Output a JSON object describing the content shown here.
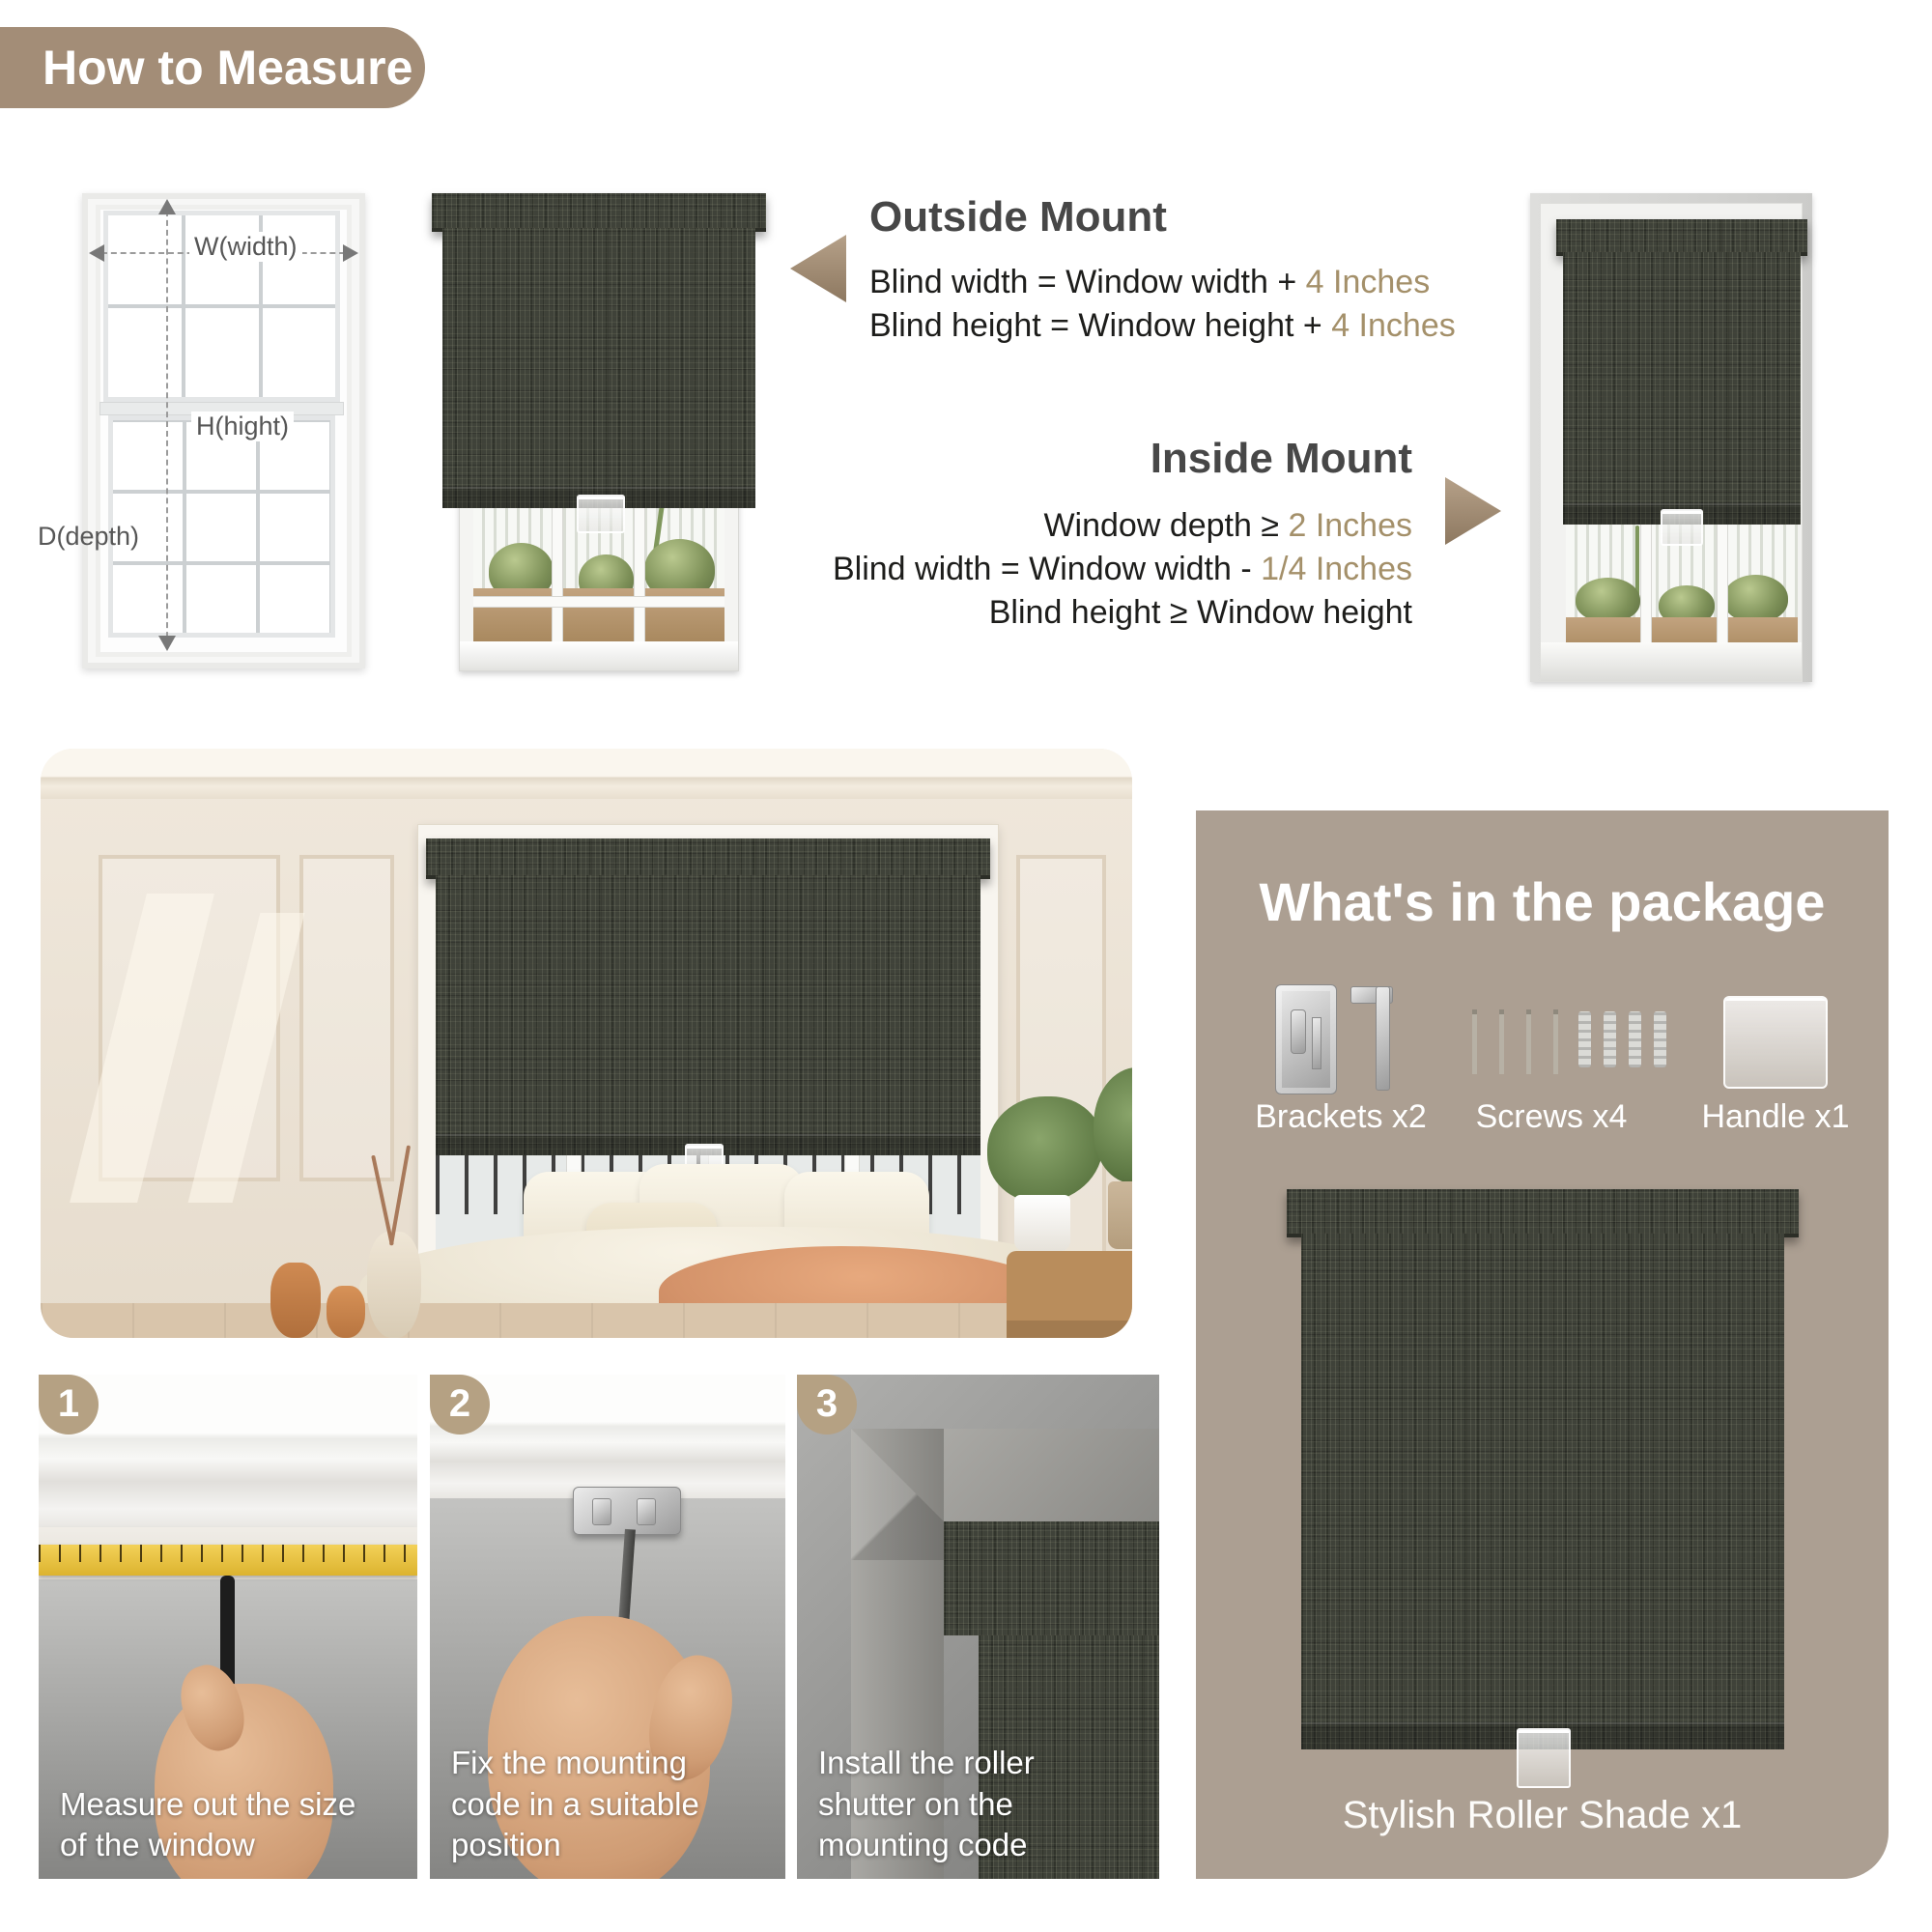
{
  "page_title": "How to Measure",
  "colors": {
    "pill_bg": "#a38d77",
    "accent_text": "#a4906a",
    "panel_bg": "#ac9f92",
    "badge_bg": "#b5a183",
    "arrow": "#a8927a",
    "fabric": "#3f4239",
    "heading_text": "#474747"
  },
  "measure_diagram": {
    "width_label": "W(width)",
    "height_label": "H(hight)",
    "depth_label": "D(depth)"
  },
  "outside_mount": {
    "heading": "Outside Mount",
    "lines": [
      {
        "text": "Blind width = Window width + ",
        "accent": "4 Inches"
      },
      {
        "text": "Blind height = Window height + ",
        "accent": "4 Inches"
      }
    ]
  },
  "inside_mount": {
    "heading": "Inside Mount",
    "lines": [
      {
        "text": "Window depth ≥ ",
        "accent": "2 Inches"
      },
      {
        "text": "Blind width = Window width - ",
        "accent": "1/4 Inches"
      },
      {
        "text": "Blind height ≥ Window height",
        "accent": ""
      }
    ]
  },
  "package": {
    "heading": "What's in the package",
    "items": [
      {
        "label": "Brackets x2"
      },
      {
        "label": "Screws x4"
      },
      {
        "label": "Handle x1"
      }
    ],
    "product_label": "Stylish Roller Shade x1"
  },
  "steps": [
    {
      "number": "1",
      "caption": "Measure out the size of the window"
    },
    {
      "number": "2",
      "caption": "Fix the mounting code in a suitable position"
    },
    {
      "number": "3",
      "caption": "Install the roller shutter on the mounting code"
    }
  ]
}
